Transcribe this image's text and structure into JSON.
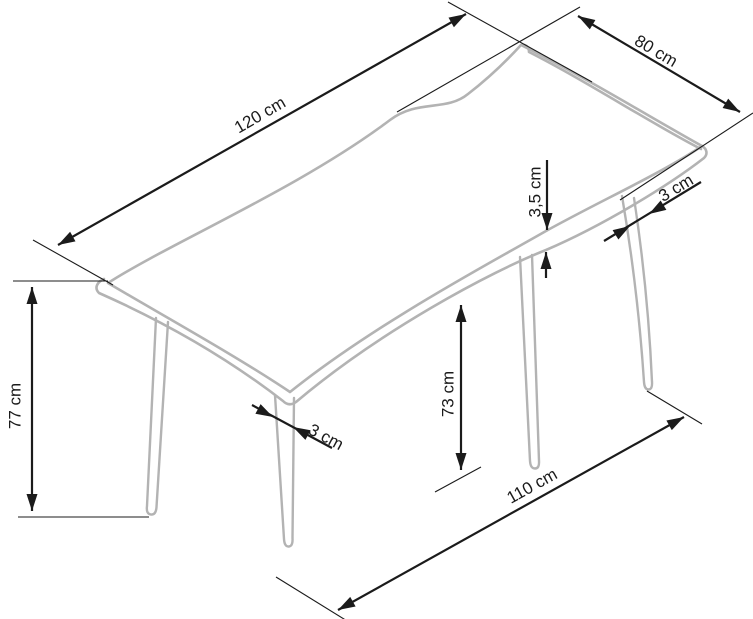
{
  "diagram": {
    "kind": "furniture-dimension-drawing",
    "units": "cm",
    "colors": {
      "furniture_outline": "#b3b3b3",
      "dimension_lines": "#1b1b1b",
      "background": "#ffffff"
    },
    "labels": {
      "top_length": "120 cm",
      "top_depth": "80 cm",
      "height": "77 cm",
      "underside_height": "73 cm",
      "top_thickness": "3,5 cm",
      "front_leg_diameter": "3 cm",
      "back_leg_diameter": "3 cm",
      "floor_span": "110 cm"
    }
  }
}
